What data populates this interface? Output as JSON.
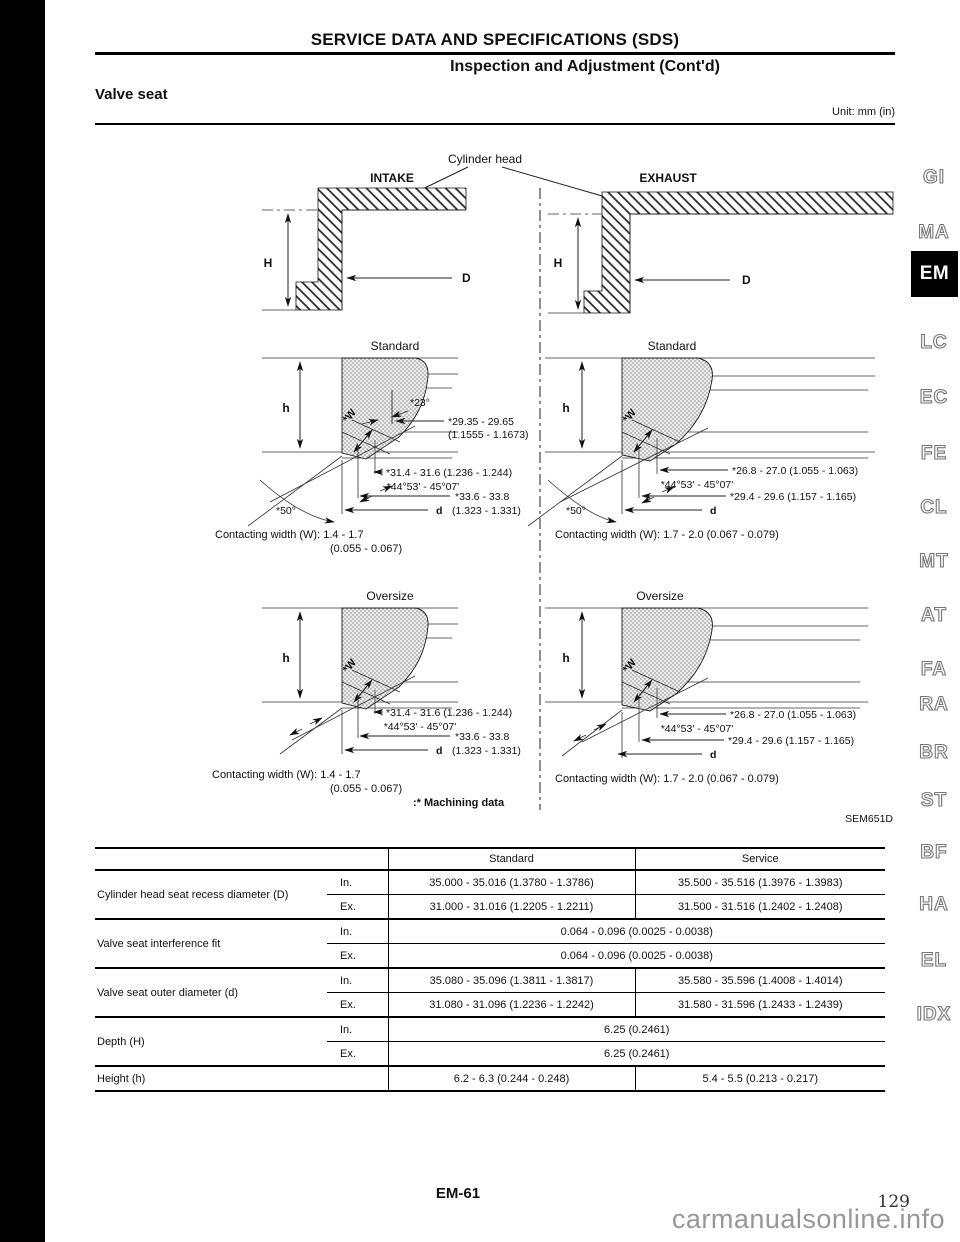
{
  "page": {
    "header_title": "SERVICE DATA AND SPECIFICATIONS (SDS)",
    "subtitle": "Inspection and Adjustment (Cont'd)",
    "section_title": "Valve seat",
    "unit_note": "Unit: mm (in)",
    "footer_page_code": "EM-61",
    "page_number": "129",
    "watermark": "carmanualsonline.info"
  },
  "sidebar": {
    "items": [
      {
        "label": "GI"
      },
      {
        "label": "MA"
      },
      {
        "label": "EM",
        "active": true
      },
      {
        "label": "LC"
      },
      {
        "label": "EC"
      },
      {
        "label": "FE"
      },
      {
        "label": "CL"
      },
      {
        "label": "MT"
      },
      {
        "label": "AT"
      },
      {
        "label": "FA"
      },
      {
        "label": "RA"
      },
      {
        "label": "BR"
      },
      {
        "label": "ST"
      },
      {
        "label": "BF"
      },
      {
        "label": "HA"
      },
      {
        "label": "EL"
      },
      {
        "label": "IDX"
      }
    ]
  },
  "diagram": {
    "cylinder_head_label": "Cylinder head",
    "intake_label": "INTAKE",
    "exhaust_label": "EXHAUST",
    "H": "H",
    "D": "D",
    "h": "h",
    "d": "d",
    "W": "*W",
    "standard_label": "Standard",
    "oversize_label": "Oversize",
    "machining_note": ":* Machining data",
    "figure_code": "SEM651D",
    "intake_standard": {
      "chamfer_angle": "*23°",
      "top_diameter": "*29.35 - 29.65",
      "top_diameter_in": "(1.1555 - 1.1673)",
      "seat_diameter": "*31.4 - 31.6 (1.236 - 1.244)",
      "seat_angle": "*44°53' - 45°07'",
      "outer_diameter": "*33.6 - 33.8",
      "outer_diameter_in": "(1.323 - 1.331)",
      "bottom_angle": "*50°",
      "contacting_width": "Contacting width (W): 1.4 - 1.7",
      "contacting_width_in": "(0.055 - 0.067)"
    },
    "exhaust_standard": {
      "seat_diameter": "*26.8 - 27.0 (1.055 - 1.063)",
      "seat_angle": "*44°53' - 45°07'",
      "outer_diameter": "*29.4 - 29.6 (1.157 - 1.165)",
      "bottom_angle": "*50°",
      "contacting_width": "Contacting width (W): 1.7 - 2.0 (0.067 - 0.079)"
    },
    "intake_oversize": {
      "seat_diameter": "*31.4 - 31.6 (1.236 - 1.244)",
      "seat_angle": "*44°53' - 45°07'",
      "outer_diameter": "*33.6 - 33.8",
      "outer_diameter_in": "(1.323 - 1.331)",
      "contacting_width": "Contacting width (W): 1.4 - 1.7",
      "contacting_width_in": "(0.055 - 0.067)"
    },
    "exhaust_oversize": {
      "seat_diameter": "*26.8 - 27.0 (1.055 - 1.063)",
      "seat_angle": "*44°53' - 45°07'",
      "outer_diameter": "*29.4 - 29.6 (1.157 - 1.165)",
      "contacting_width": "Contacting width (W): 1.7 - 2.0 (0.067 - 0.079)"
    }
  },
  "table": {
    "col_standard": "Standard",
    "col_service": "Service",
    "in_label": "In.",
    "ex_label": "Ex.",
    "rows": {
      "recess": {
        "label": "Cylinder head seat recess diameter (D)",
        "in_standard": "35.000 - 35.016 (1.3780 - 1.3786)",
        "in_service": "35.500 - 35.516 (1.3976 - 1.3983)",
        "ex_standard": "31.000 - 31.016 (1.2205 - 1.2211)",
        "ex_service": "31.500 - 31.516 (1.2402 - 1.2408)"
      },
      "interference": {
        "label": "Valve seat interference fit",
        "in_value": "0.064 - 0.096 (0.0025 - 0.0038)",
        "ex_value": "0.064 - 0.096 (0.0025 - 0.0038)"
      },
      "outer": {
        "label": "Valve seat outer diameter (d)",
        "in_standard": "35.080 - 35.096 (1.3811 - 1.3817)",
        "in_service": "35.580 - 35.596 (1.4008 - 1.4014)",
        "ex_standard": "31.080 - 31.096 (1.2236 - 1.2242)",
        "ex_service": "31.580 - 31.596 (1.2433 - 1.2439)"
      },
      "depth": {
        "label": "Depth (H)",
        "in_value": "6.25 (0.2461)",
        "ex_value": "6.25 (0.2461)"
      },
      "height": {
        "label": "Height (h)",
        "standard": "6.2 - 6.3 (0.244 - 0.248)",
        "service": "5.4 - 5.5 (0.213 - 0.217)"
      }
    }
  }
}
